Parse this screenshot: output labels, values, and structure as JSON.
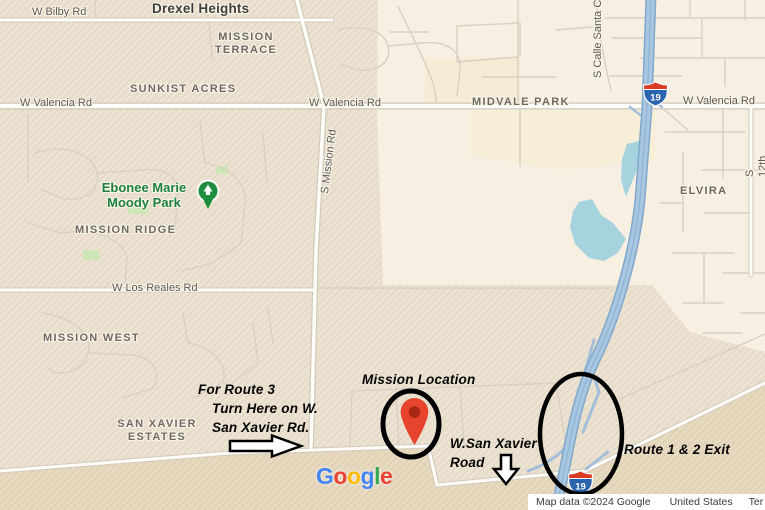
{
  "map": {
    "city_label": "Drexel Heights",
    "area_labels": {
      "mission_terrace": "MISSION\nTERRACE",
      "sunkist_acres": "SUNKIST ACRES",
      "midvale_park": "MIDVALE PARK",
      "elvira": "ELVIRA",
      "mission_ridge": "MISSION RIDGE",
      "mission_west": "MISSION WEST",
      "san_xavier_estates": "SAN XAVIER\nESTATES"
    },
    "road_labels": {
      "w_bilby_rd": "W Bilby Rd",
      "w_valencia_rd_left": "W Valencia Rd",
      "w_valencia_rd_mid": "W Valencia Rd",
      "w_valencia_rd_right": "W Valencia Rd",
      "s_mission_rd": "S Mission Rd",
      "s_calle_santa": "S Calle Santa C",
      "s_12th_ave": "S 12th Ave",
      "w_los_reales_rd": "W Los Reales Rd"
    },
    "poi": {
      "park_name": "Ebonee Marie\nMoody Park"
    },
    "shield_label": "19"
  },
  "annotations": {
    "route3_line1": "For Route 3",
    "route3_line2": "Turn Here on W.",
    "route3_line3": "San Xavier Rd.",
    "mission_location": "Mission Location",
    "san_xavier_line1": "W.San Xavier",
    "san_xavier_line2": "Road",
    "route_1_2_exit": "Route 1 & 2 Exit"
  },
  "footer": {
    "logo_letters": [
      "G",
      "o",
      "o",
      "g",
      "l",
      "e"
    ],
    "attribution": "Map data ©2024 Google",
    "country": "United States",
    "terms": "Ter"
  },
  "colors": {
    "pin_red": "#E8432D",
    "pin_inner": "#A52714",
    "highway_blue": "#A9C6E1",
    "highway_casing": "#7FA8CA",
    "water_blue": "#A6D3DD",
    "park_green": "#1E8E3E",
    "shield_blue": "#2A63AE",
    "shield_red": "#DC3B23",
    "annotation_black": "#000000",
    "logo_blue": "#4285F4",
    "logo_red": "#EA4335",
    "logo_yellow": "#FBBC05",
    "logo_green": "#34A853"
  }
}
